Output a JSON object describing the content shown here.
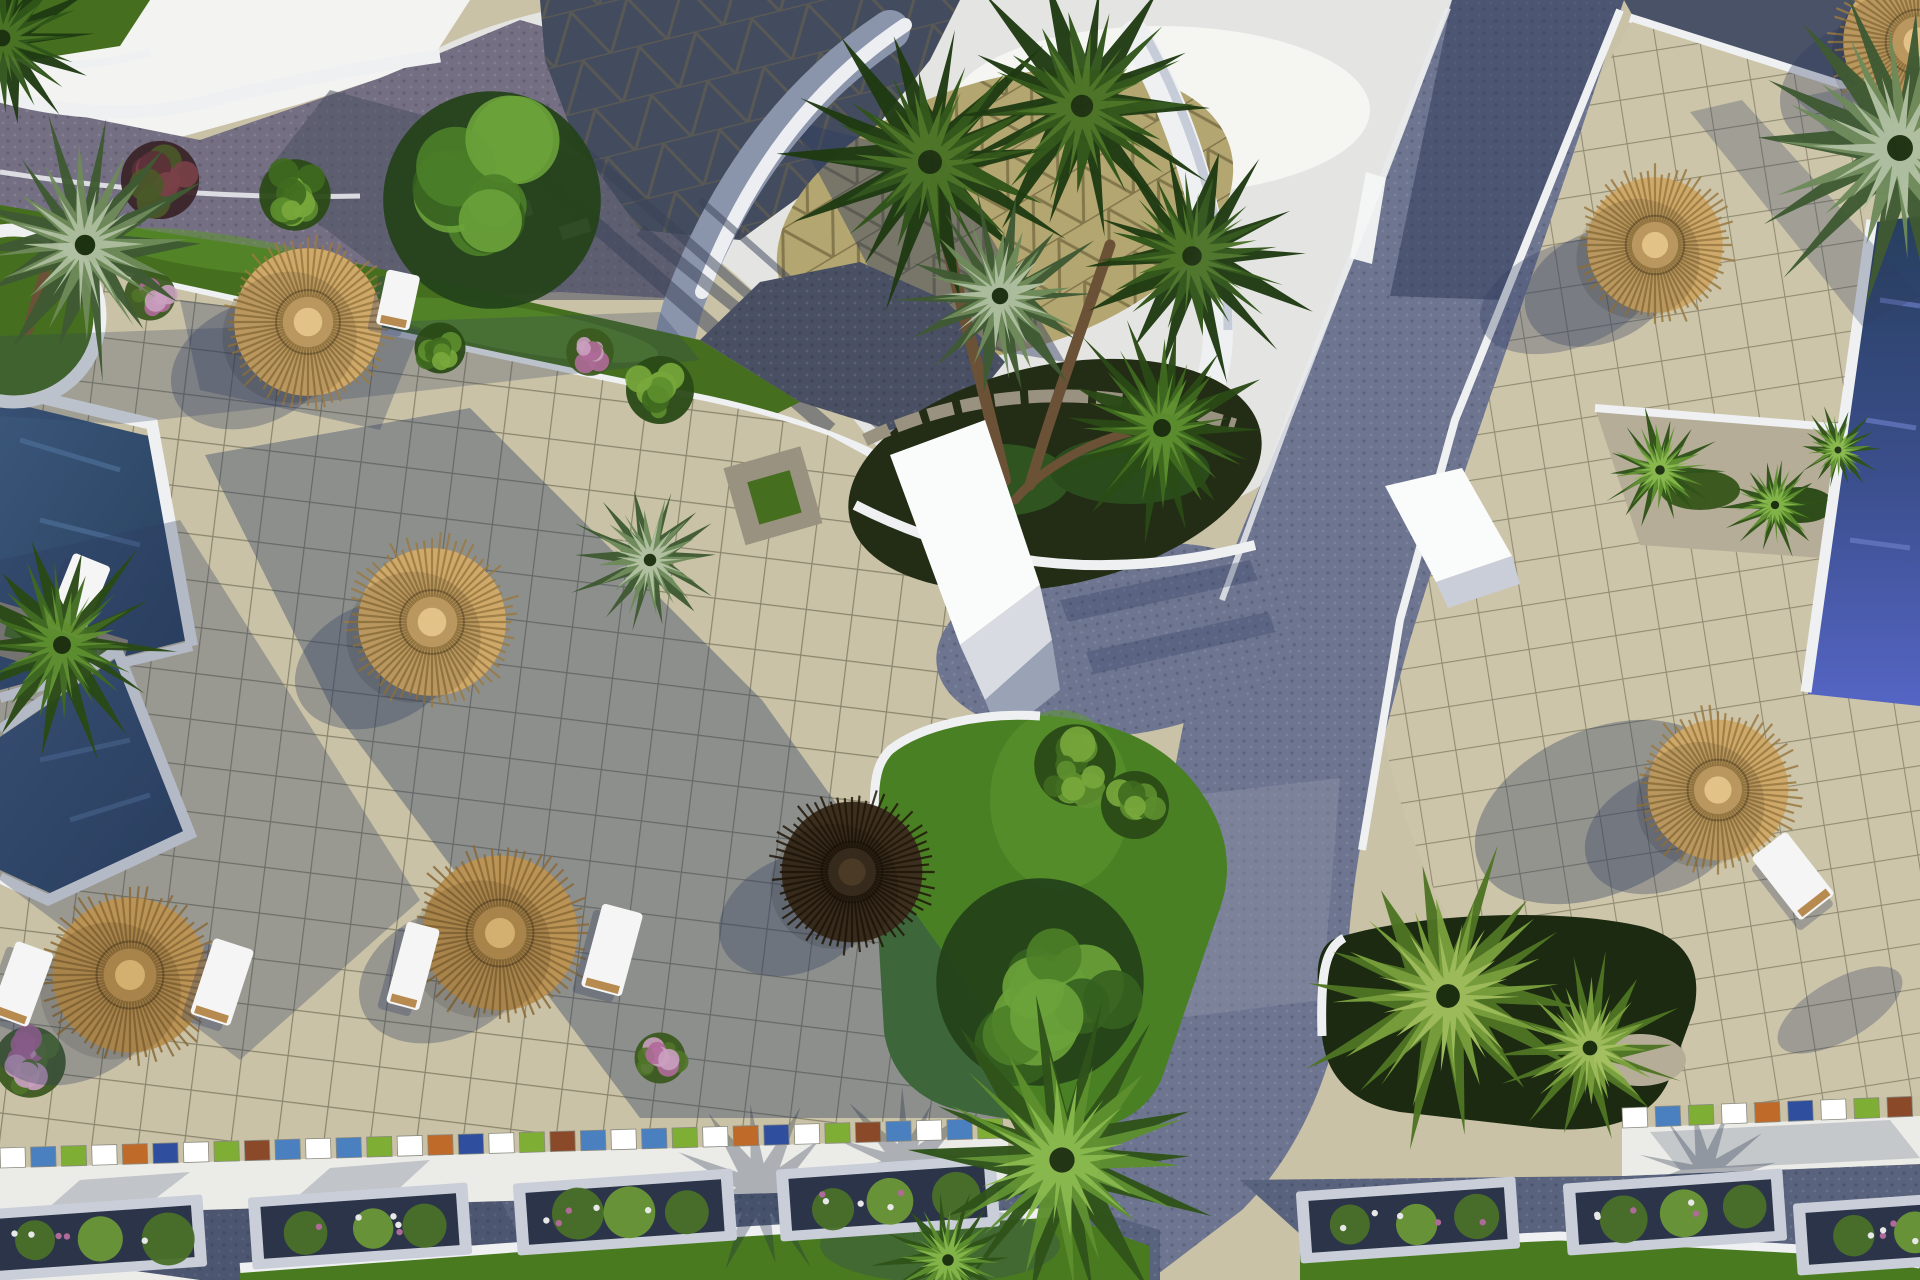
{
  "meta": {
    "title": "Aerial 3D architectural rendering of a resort courtyard",
    "description": "Top-down 3D visualization of a resort: tiled plazas with straw parasols and sun loungers, navy swimming pools, palm trees, curved white roof structures with triangular-patterned shingles, dark cobblestone walkways, lawn strips, flower planters and a mosaic-edged street at the bottom.",
    "type": "architectural-visualization",
    "view": "aerial-top-down"
  },
  "palette": {
    "plaza": "#c9c2a6",
    "plazaLit": "#d6cfb2",
    "plazaWarm": "#cdc5a9",
    "gridLine": "#55543f",
    "shadow": "#2e3c60",
    "skyGray": "#e4e4e2",
    "skyWhite": "#f6f6f4",
    "whiteSurf": "#f3f3f1",
    "curb": "#eef0f2",
    "roadCobble": "#756f84",
    "roadDark": "#4a5063",
    "bandDark": "#3e4867",
    "gravel": "#6d7590",
    "gravelLit": "#8b92a6",
    "roofDark": "#434b5e",
    "roofKhaki": "#b4a671",
    "roofTriLine": "#7a6e45",
    "ribbonBlue": "#8a94aa",
    "darkStrip": "#4a5268",
    "lawn": "#456f1e",
    "lawnBright": "#5d9630",
    "planterLawn": "#4a8024",
    "soil": "#232d15",
    "soilDark": "#1b2a10",
    "stone": "#9a9280",
    "stoneWall": "#938c79",
    "graveBed": "#b5ad97",
    "poolNavy": "#2e4a6b",
    "poolDeep": "#273f5e",
    "poolIndigo": "#5565c4",
    "trunk": "#6b5135",
    "wood": "#b78a50",
    "white": "#f4f5f4",
    "paleSide": "#c9ced8",
    "flowerPink": "#b06a9a"
  },
  "scene": {
    "umbrellas": [
      {
        "cx": 308,
        "cy": 322,
        "r": 84,
        "tone": "light"
      },
      {
        "cx": 432,
        "cy": 622,
        "r": 84,
        "tone": "light"
      },
      {
        "cx": 500,
        "cy": 933,
        "r": 88,
        "tone": "mid"
      },
      {
        "cx": 130,
        "cy": 975,
        "r": 88,
        "tone": "mid"
      },
      {
        "cx": 852,
        "cy": 872,
        "r": 80,
        "tone": "dark"
      },
      {
        "cx": 1718,
        "cy": 790,
        "r": 80,
        "tone": "light"
      },
      {
        "cx": 1655,
        "cy": 245,
        "r": 77,
        "tone": "light"
      },
      {
        "cx": 1918,
        "cy": 42,
        "r": 85,
        "tone": "light"
      }
    ],
    "loungers": [
      {
        "cx": 22,
        "cy": 984,
        "w": 40,
        "h": 78,
        "rot": 20
      },
      {
        "cx": 222,
        "cy": 982,
        "w": 42,
        "h": 80,
        "rot": 18
      },
      {
        "cx": 413,
        "cy": 966,
        "w": 34,
        "h": 84,
        "rot": 15
      },
      {
        "cx": 612,
        "cy": 950,
        "w": 42,
        "h": 86,
        "rot": 15
      },
      {
        "cx": 398,
        "cy": 300,
        "w": 34,
        "h": 56,
        "rot": 12
      },
      {
        "cx": 1793,
        "cy": 876,
        "w": 44,
        "h": 80,
        "rot": -38
      },
      {
        "cx": 78,
        "cy": 596,
        "w": 40,
        "h": 78,
        "rot": 22
      }
    ],
    "palms": [
      {
        "cx": 930,
        "cy": 162,
        "r": 150,
        "tone": "dark"
      },
      {
        "cx": 1082,
        "cy": 106,
        "r": 140,
        "tone": "dark"
      },
      {
        "cx": 1192,
        "cy": 256,
        "r": 122,
        "tone": "dark"
      },
      {
        "cx": 1000,
        "cy": 296,
        "r": 103,
        "tone": "silver"
      },
      {
        "cx": 1162,
        "cy": 428,
        "r": 112,
        "tone": "mid"
      },
      {
        "cx": 1900,
        "cy": 148,
        "r": 162,
        "tone": "silver"
      },
      {
        "cx": 85,
        "cy": 245,
        "r": 128,
        "tone": "silver"
      },
      {
        "cx": 62,
        "cy": 645,
        "r": 112,
        "tone": "mid"
      },
      {
        "cx": 2,
        "cy": 38,
        "r": 105,
        "tone": "dark"
      },
      {
        "cx": 1062,
        "cy": 1160,
        "r": 158,
        "tone": "bright"
      },
      {
        "cx": 948,
        "cy": 1260,
        "r": 72,
        "tone": "bright"
      },
      {
        "cx": 1448,
        "cy": 996,
        "r": 148,
        "tone": "yellow"
      },
      {
        "cx": 1590,
        "cy": 1048,
        "r": 92,
        "tone": "yellow"
      },
      {
        "cx": 650,
        "cy": 560,
        "r": 78,
        "tone": "silver"
      },
      {
        "cx": 1660,
        "cy": 470,
        "r": 60,
        "tone": "bright"
      },
      {
        "cx": 1775,
        "cy": 505,
        "r": 52,
        "tone": "bright"
      },
      {
        "cx": 1838,
        "cy": 450,
        "r": 44,
        "tone": "bright"
      }
    ],
    "bushes": [
      {
        "cx": 492,
        "cy": 200,
        "r": 128,
        "theme": "tree"
      },
      {
        "cx": 1040,
        "cy": 982,
        "r": 122,
        "theme": "tree"
      },
      {
        "cx": 160,
        "cy": 180,
        "r": 46,
        "theme": "red"
      },
      {
        "cx": 295,
        "cy": 195,
        "r": 42,
        "theme": "mid"
      },
      {
        "cx": 660,
        "cy": 390,
        "r": 40,
        "theme": "mid"
      },
      {
        "cx": 590,
        "cy": 352,
        "r": 28,
        "theme": "flower"
      },
      {
        "cx": 440,
        "cy": 348,
        "r": 30,
        "theme": "mid"
      },
      {
        "cx": 150,
        "cy": 295,
        "r": 30,
        "theme": "flower"
      },
      {
        "cx": 660,
        "cy": 1058,
        "r": 30,
        "theme": "flower"
      },
      {
        "cx": 30,
        "cy": 1062,
        "r": 42,
        "theme": "flower"
      },
      {
        "cx": 1075,
        "cy": 765,
        "r": 48,
        "theme": "mid"
      },
      {
        "cx": 1135,
        "cy": 805,
        "r": 40,
        "theme": "mid"
      }
    ],
    "shadow_palms": [
      {
        "cx": 760,
        "cy": 1190,
        "r": 90
      },
      {
        "cx": 905,
        "cy": 1165,
        "r": 80
      },
      {
        "cx": 1705,
        "cy": 1175,
        "r": 70
      }
    ],
    "mosaic": {
      "thickness": 20,
      "segment_colors": [
        "#ffffff",
        "#4a7fc0",
        "#7fae35",
        "#ffffff",
        "#c06a2a",
        "#2f4f9e",
        "#ffffff",
        "#7fae35",
        "#8a4a2a",
        "#4a7fc0"
      ],
      "runs": [
        {
          "x1": 0,
          "y1": 1148,
          "x2": 1008,
          "y2": 1118
        },
        {
          "x1": 1622,
          "y1": 1108,
          "x2": 1920,
          "y2": 1096
        }
      ]
    },
    "road_planters": [
      {
        "cx": 95,
        "cy": 1238,
        "rot": -4
      },
      {
        "cx": 360,
        "cy": 1226,
        "rot": -4
      },
      {
        "cx": 625,
        "cy": 1212,
        "rot": -4
      },
      {
        "cx": 888,
        "cy": 1198,
        "rot": -4
      },
      {
        "cx": 1408,
        "cy": 1220,
        "rot": -4
      },
      {
        "cx": 1675,
        "cy": 1212,
        "rot": -4
      },
      {
        "cx": 1905,
        "cy": 1232,
        "rot": -4
      }
    ],
    "counts": {
      "pools": 3,
      "straw_umbrellas": 8,
      "sun_loungers": 7,
      "street_planters": 7
    }
  }
}
